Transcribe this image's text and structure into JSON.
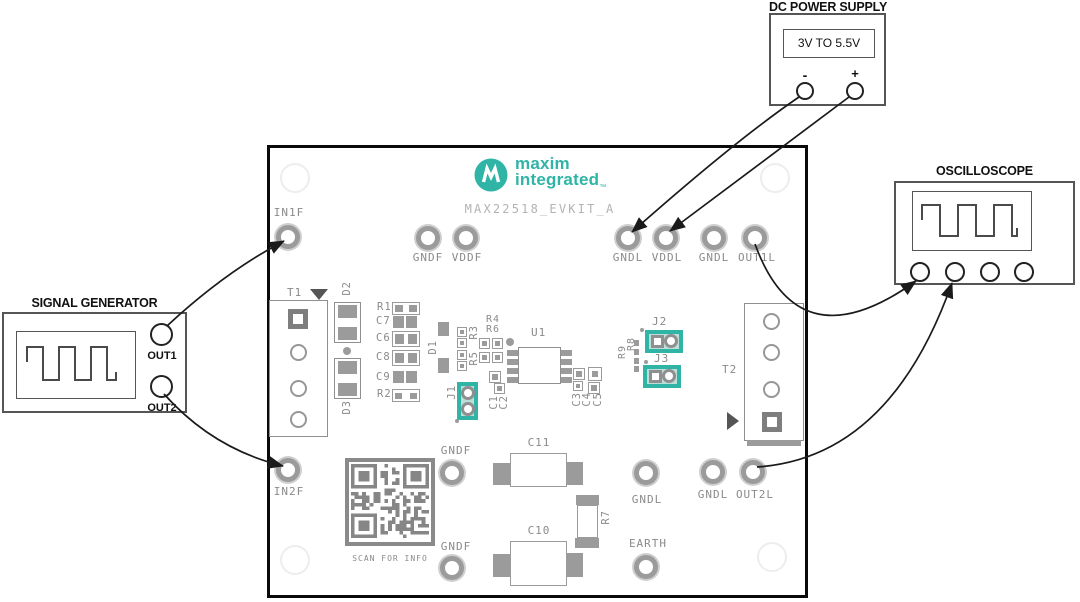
{
  "instruments": {
    "signal_generator": {
      "title": "SIGNAL GENERATOR",
      "out1": "OUT1",
      "out2": "OUT2"
    },
    "dc_power_supply": {
      "title": "DC POWER SUPPLY",
      "range": "3V TO 5.5V",
      "minus": "-",
      "plus": "+"
    },
    "oscilloscope": {
      "title": "OSCILLOSCOPE"
    }
  },
  "board": {
    "brand": {
      "line1": "maxim",
      "line2": "integrated",
      "tm": "™"
    },
    "name": "MAX22518_EVKIT_A",
    "qr_caption": "SCAN FOR INFO",
    "testpoints": {
      "in1f": "IN1F",
      "gndf_top": "GNDF",
      "vddf": "VDDF",
      "gndl_a": "GNDL",
      "vddl": "VDDL",
      "gndl_b": "GNDL",
      "out1l": "OUT1L",
      "in2f": "IN2F",
      "gndf_mid": "GNDF",
      "gndf_low": "GNDF",
      "gndl_c": "GNDL",
      "earth": "EARTH",
      "gndl_d": "GNDL",
      "out2l": "OUT2L"
    },
    "refs": {
      "t1": "T1",
      "t2": "T2",
      "u1": "U1",
      "d1": "D1",
      "d2": "D2",
      "d3": "D3",
      "r1": "R1",
      "r2": "R2",
      "r3": "R3",
      "r4": "R4",
      "r5": "R5",
      "r6": "R6",
      "r7": "R7",
      "r8": "R8",
      "r9": "R9",
      "c1": "C1",
      "c2": "C2",
      "c3": "C3",
      "c4": "C4",
      "c5": "C5",
      "c6": "C6",
      "c7": "C7",
      "c8": "C8",
      "c9": "C9",
      "c10": "C10",
      "c11": "C11",
      "j1": "J1",
      "j2": "J2",
      "j3": "J3"
    }
  },
  "colors": {
    "teal": "#2fb4a5",
    "jumper_fill": "#bcded8",
    "silkscreen": "#8a8a8a",
    "board_name_text": "#b3b3b3",
    "arrow": "#1a1a1a"
  }
}
